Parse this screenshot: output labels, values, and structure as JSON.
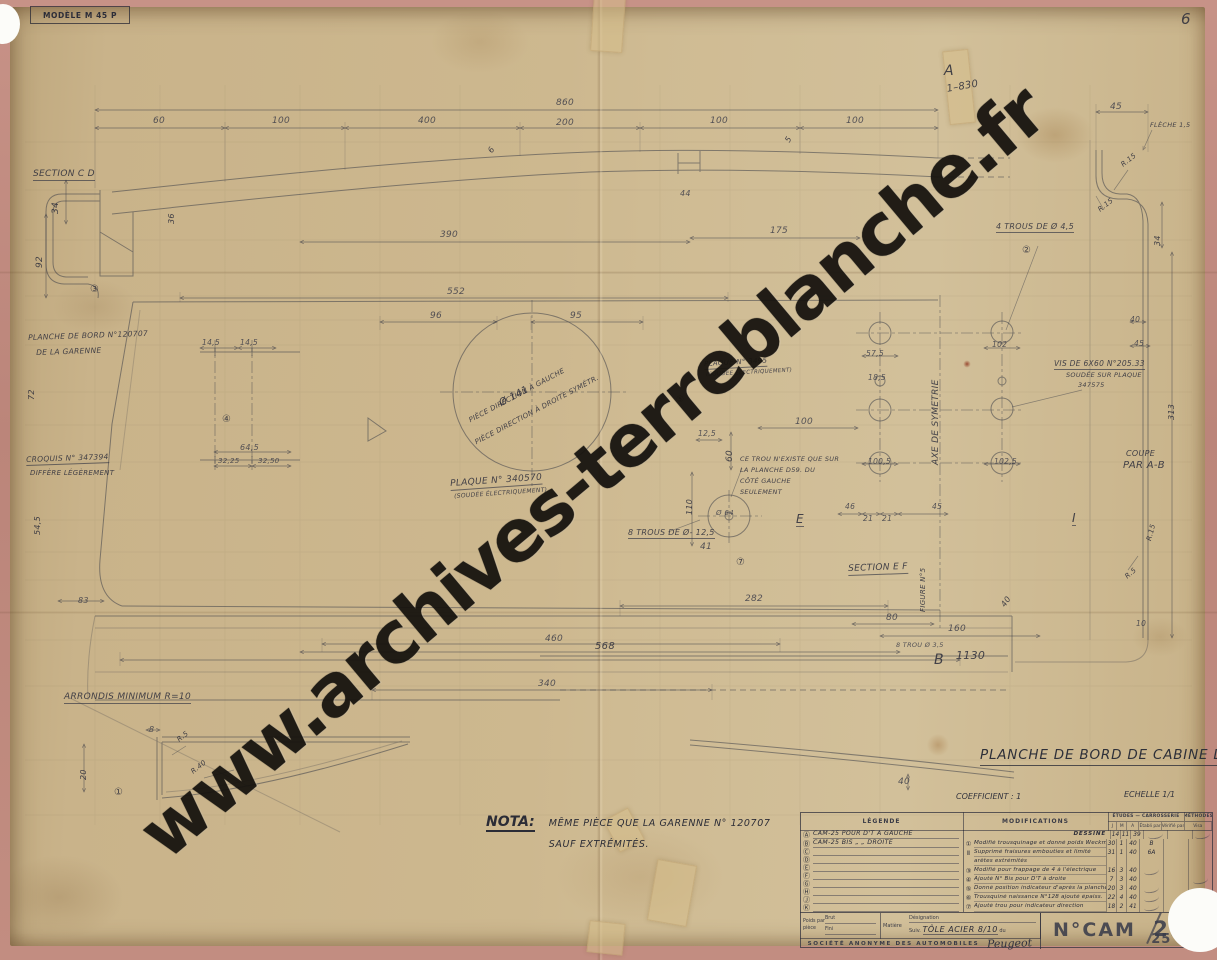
{
  "watermark": {
    "text": "www.archives-terreblanche.fr"
  },
  "stamp": {
    "label": "MODÈLE M 45 P"
  },
  "title": "PLANCHE DE BORD DE CABINE D.S.A.",
  "coefficient": "COEFFICIENT : 1",
  "echelle": "ECHELLE 1/1",
  "nota": {
    "label": "NOTA:",
    "line1": "MÊME PIÈCE QUE LA GARENNE N° 120707",
    "line2": "SAUF EXTRÉMITÉS."
  },
  "colors": {
    "paper": "#cdb88f",
    "frame": "#c08a7d",
    "ink": "#2f3039",
    "pencil": "#3e4049",
    "watermark": "#16130e"
  },
  "title_block": {
    "legend_header": "LÉGENDE",
    "modifications_header": "MODIFICATIONS",
    "dept_header_1": "ÉTUDES — CARROSSERIE",
    "dept_header_2": "MÉTHODES",
    "date_cols": [
      "J",
      "M",
      "A",
      "Établi par",
      "Vérifié par",
      "Visa"
    ],
    "legend_rows": [
      {
        "k": "Ⓐ",
        "t": "CAM-25 POUR D'T À GAUCHE"
      },
      {
        "k": "Ⓑ",
        "t": "CAM-25 BIS   „   „   DROITE"
      },
      {
        "k": "Ⓒ",
        "t": ""
      },
      {
        "k": "Ⓓ",
        "t": ""
      },
      {
        "k": "Ⓔ",
        "t": ""
      },
      {
        "k": "Ⓕ",
        "t": ""
      },
      {
        "k": "Ⓖ",
        "t": ""
      },
      {
        "k": "Ⓗ",
        "t": ""
      },
      {
        "k": "Ⓙ",
        "t": ""
      },
      {
        "k": "Ⓚ",
        "t": ""
      }
    ],
    "mod_rows": [
      {
        "n": "",
        "t": "DESSINÉ",
        "rt": true,
        "d": "14",
        "m": "11",
        "a": "39",
        "s1": true,
        "s2": true
      },
      {
        "n": "①",
        "t": "Modifié trousquinage et donné poids Weckmann",
        "d": "30",
        "m": "1",
        "a": "40",
        "by": "B"
      },
      {
        "n": "Ⅱ",
        "t": "Supprimé fraisures embouties et limité",
        "d": "31",
        "m": "1",
        "a": "40",
        "by": "6A"
      },
      {
        "n": "",
        "t": "arêtes extrémités"
      },
      {
        "n": "③",
        "t": "Modifié pour frappage de 4 à l'électrique",
        "d": "16",
        "m": "3",
        "a": "40",
        "s1": true
      },
      {
        "n": "④",
        "t": "Ajouté N° Bis pour D'T à droite",
        "d": "7",
        "m": "3",
        "a": "40",
        "s2": true
      },
      {
        "n": "⑤",
        "t": "Donné position indicateur d'après la planche",
        "d": "20",
        "m": "3",
        "a": "40",
        "s1": true
      },
      {
        "n": "⑥",
        "t": "Trousquiné naissance N°128 ajouté épaiss.",
        "d": "22",
        "m": "4",
        "a": "40",
        "s1": true,
        "s2": true
      },
      {
        "n": "⑦",
        "t": "Ajouté trou pour indicateur direction",
        "d": "18",
        "m": "2",
        "a": "41",
        "s1": true
      }
    ],
    "bottom": {
      "poids_label": "Poids par pièce",
      "brut_label": "Brut",
      "fini_label": "Fini",
      "matiere_label": "Matière",
      "designation_label": "Désignation",
      "suiv_label": "Suiv.",
      "matiere_value": "TÔLE ACIER 8/10",
      "du_label": "du",
      "number_prefix": "N°CAM",
      "number": "25",
      "number_bis": "25 BIS",
      "company": "SOCIÉTÉ ANONYME DES AUTOMOBILES",
      "brand": "Peugeot"
    }
  },
  "annotations": [
    {
      "t": "860",
      "x": 556,
      "y": 99,
      "c": "d"
    },
    {
      "t": "60",
      "x": 153,
      "y": 117,
      "c": "d"
    },
    {
      "t": "100",
      "x": 272,
      "y": 117,
      "c": "d"
    },
    {
      "t": "400",
      "x": 418,
      "y": 117,
      "c": "d"
    },
    {
      "t": "200",
      "x": 556,
      "y": 119,
      "c": "d"
    },
    {
      "t": "100",
      "x": 710,
      "y": 117,
      "c": "d"
    },
    {
      "t": "100",
      "x": 846,
      "y": 117,
      "c": "d"
    },
    {
      "t": "45",
      "x": 1110,
      "y": 103,
      "c": "d"
    },
    {
      "t": "FLÈCHE 1,5",
      "x": 1150,
      "y": 122,
      "c": "h",
      "s": 6.5
    },
    {
      "t": "A",
      "x": 944,
      "y": 64,
      "c": "h",
      "s": 14
    },
    {
      "t": "1–830",
      "x": 946,
      "y": 85,
      "c": "h",
      "s": 10,
      "r": -10
    },
    {
      "t": "6",
      "x": 1181,
      "y": 12,
      "c": "h",
      "s": 15
    },
    {
      "t": "SECTION C D",
      "x": 33,
      "y": 170,
      "c": "hu",
      "s": 9
    },
    {
      "t": "34",
      "x": 52,
      "y": 214,
      "c": "v",
      "s": 9
    },
    {
      "t": "92",
      "x": 36,
      "y": 268,
      "c": "v",
      "s": 9
    },
    {
      "t": "36",
      "x": 168,
      "y": 224,
      "c": "v",
      "s": 8
    },
    {
      "t": "6",
      "x": 487,
      "y": 150,
      "c": "h",
      "r": -55,
      "s": 8
    },
    {
      "t": "5",
      "x": 784,
      "y": 140,
      "c": "h",
      "r": -60,
      "s": 8
    },
    {
      "t": "44",
      "x": 680,
      "y": 190,
      "c": "d",
      "s": 8
    },
    {
      "t": "390",
      "x": 440,
      "y": 231,
      "c": "d"
    },
    {
      "t": "175",
      "x": 770,
      "y": 227,
      "c": "d"
    },
    {
      "t": "4 TROUS DE Ø 4,5",
      "x": 996,
      "y": 223,
      "c": "hu",
      "s": 8
    },
    {
      "t": "②",
      "x": 1022,
      "y": 246,
      "c": "h",
      "s": 10
    },
    {
      "t": "③",
      "x": 90,
      "y": 285,
      "c": "h",
      "s": 10
    },
    {
      "t": "PLANCHE DE BORD N°120707",
      "x": 28,
      "y": 334,
      "c": "h",
      "s": 7.5,
      "r": -2
    },
    {
      "t": "DE LA GARENNE",
      "x": 36,
      "y": 349,
      "c": "h",
      "s": 7.5,
      "r": -2
    },
    {
      "t": "72",
      "x": 28,
      "y": 400,
      "c": "v",
      "s": 8
    },
    {
      "t": "CROQUIS N° 347394",
      "x": 26,
      "y": 456,
      "c": "hu",
      "s": 7.5,
      "r": -2
    },
    {
      "t": "DIFFÈRE LÉGÈREMENT",
      "x": 30,
      "y": 470,
      "c": "h",
      "s": 7
    },
    {
      "t": "54,5",
      "x": 34,
      "y": 535,
      "c": "v",
      "s": 8
    },
    {
      "t": "552",
      "x": 447,
      "y": 288,
      "c": "d"
    },
    {
      "t": "96",
      "x": 430,
      "y": 312,
      "c": "d"
    },
    {
      "t": "95",
      "x": 570,
      "y": 312,
      "c": "d"
    },
    {
      "t": "14,5",
      "x": 202,
      "y": 339,
      "c": "d",
      "s": 7.5
    },
    {
      "t": "14,5",
      "x": 240,
      "y": 339,
      "c": "d",
      "s": 7.5
    },
    {
      "t": "④",
      "x": 222,
      "y": 415,
      "c": "h",
      "s": 10
    },
    {
      "t": "64,5",
      "x": 240,
      "y": 444,
      "c": "d",
      "s": 8
    },
    {
      "t": "32,25",
      "x": 218,
      "y": 458,
      "c": "d",
      "s": 7
    },
    {
      "t": "32,50",
      "x": 258,
      "y": 458,
      "c": "d",
      "s": 7
    },
    {
      "t": "Ø 141",
      "x": 498,
      "y": 400,
      "c": "h",
      "r": -28,
      "s": 10
    },
    {
      "t": "PIÈCE DIRECTION À GAUCHE",
      "x": 468,
      "y": 418,
      "c": "h",
      "r": -28,
      "s": 7
    },
    {
      "t": "PIÈCE DIRECTION À DROITE SYMÉTR.",
      "x": 474,
      "y": 440,
      "c": "h",
      "r": -28,
      "s": 7
    },
    {
      "t": "PLAQUE N° 340570",
      "x": 450,
      "y": 480,
      "c": "hu",
      "r": -4,
      "s": 9
    },
    {
      "t": "(SOUDÉE ÉLECTRIQUEMENT)",
      "x": 454,
      "y": 494,
      "c": "h",
      "s": 6,
      "r": -4
    },
    {
      "t": "PLAQUE N° 3495",
      "x": 704,
      "y": 361,
      "c": "hu",
      "s": 7,
      "r": -3
    },
    {
      "t": "(SOUDÉE ÉLECTRIQUEMENT)",
      "x": 706,
      "y": 373,
      "c": "h",
      "s": 5.5,
      "r": -3
    },
    {
      "t": "⑤",
      "x": 676,
      "y": 396,
      "c": "h",
      "s": 9
    },
    {
      "t": "12,5",
      "x": 698,
      "y": 430,
      "c": "d",
      "s": 7.5
    },
    {
      "t": "60",
      "x": 726,
      "y": 462,
      "c": "v",
      "s": 9
    },
    {
      "t": "100",
      "x": 795,
      "y": 418,
      "c": "d"
    },
    {
      "t": "CE TROU N'EXISTE QUE SUR",
      "x": 740,
      "y": 456,
      "c": "h",
      "s": 6.5
    },
    {
      "t": "LA PLANCHE D59. DU",
      "x": 740,
      "y": 467,
      "c": "h",
      "s": 6.5
    },
    {
      "t": "CÔTÉ GAUCHE",
      "x": 740,
      "y": 478,
      "c": "h",
      "s": 6.5
    },
    {
      "t": "SEULEMENT",
      "x": 740,
      "y": 489,
      "c": "h",
      "s": 6.5
    },
    {
      "t": "110",
      "x": 686,
      "y": 515,
      "c": "v",
      "s": 8
    },
    {
      "t": "Ø 64",
      "x": 716,
      "y": 510,
      "c": "d",
      "s": 7
    },
    {
      "t": "8 TROUS DE Ø- 12,5",
      "x": 628,
      "y": 529,
      "c": "hu",
      "s": 8
    },
    {
      "t": "41",
      "x": 700,
      "y": 543,
      "c": "d"
    },
    {
      "t": "⑦",
      "x": 736,
      "y": 558,
      "c": "h",
      "s": 10
    },
    {
      "t": "E",
      "x": 796,
      "y": 513,
      "c": "hu",
      "s": 12
    },
    {
      "t": "SECTION E F",
      "x": 848,
      "y": 565,
      "c": "hu",
      "s": 9,
      "r": -2
    },
    {
      "t": "FIGURE N°5",
      "x": 920,
      "y": 612,
      "c": "v",
      "s": 7
    },
    {
      "t": "46",
      "x": 845,
      "y": 503,
      "c": "d",
      "s": 7.5
    },
    {
      "t": "21",
      "x": 863,
      "y": 515,
      "c": "d",
      "s": 7.5
    },
    {
      "t": "21",
      "x": 882,
      "y": 515,
      "c": "d",
      "s": 7.5
    },
    {
      "t": "45",
      "x": 932,
      "y": 503,
      "c": "d",
      "s": 7.5
    },
    {
      "t": "57,5",
      "x": 866,
      "y": 350,
      "c": "d",
      "s": 7.5
    },
    {
      "t": "18,5",
      "x": 868,
      "y": 374,
      "c": "d",
      "s": 7.5
    },
    {
      "t": "102",
      "x": 992,
      "y": 341,
      "c": "d",
      "s": 7.5
    },
    {
      "t": "100,5",
      "x": 868,
      "y": 458,
      "c": "d",
      "s": 7.5
    },
    {
      "t": "102,5",
      "x": 994,
      "y": 458,
      "c": "d",
      "s": 7.5
    },
    {
      "t": "AXE DE SYMETRIE",
      "x": 932,
      "y": 465,
      "c": "v",
      "s": 9
    },
    {
      "t": "VIS DE 6X60 N°205.33",
      "x": 1054,
      "y": 360,
      "c": "hu",
      "s": 7.5
    },
    {
      "t": "SOUDÉE SUR PLAQUE",
      "x": 1066,
      "y": 372,
      "c": "h",
      "s": 6.5
    },
    {
      "t": "347575",
      "x": 1078,
      "y": 382,
      "c": "h",
      "s": 6.5
    },
    {
      "t": "COUPE",
      "x": 1126,
      "y": 450,
      "c": "h",
      "s": 8
    },
    {
      "t": "PAR A-B",
      "x": 1123,
      "y": 461,
      "c": "h",
      "s": 10
    },
    {
      "t": "R.15",
      "x": 1120,
      "y": 163,
      "c": "h",
      "r": -38,
      "s": 7
    },
    {
      "t": "R.15",
      "x": 1097,
      "y": 208,
      "c": "h",
      "r": -38,
      "s": 7
    },
    {
      "t": "34",
      "x": 1154,
      "y": 246,
      "c": "v",
      "s": 8
    },
    {
      "t": "40",
      "x": 1130,
      "y": 316,
      "c": "d",
      "s": 7.5
    },
    {
      "t": "45",
      "x": 1134,
      "y": 340,
      "c": "d",
      "s": 7.5
    },
    {
      "t": "313",
      "x": 1168,
      "y": 420,
      "c": "v",
      "s": 8
    },
    {
      "t": "R.15",
      "x": 1146,
      "y": 540,
      "c": "h",
      "r": -75,
      "s": 7
    },
    {
      "t": "R.5",
      "x": 1124,
      "y": 575,
      "c": "h",
      "r": -40,
      "s": 7
    },
    {
      "t": "I",
      "x": 1072,
      "y": 512,
      "c": "hu",
      "s": 12
    },
    {
      "t": "282",
      "x": 745,
      "y": 595,
      "c": "d"
    },
    {
      "t": "80",
      "x": 886,
      "y": 614,
      "c": "d"
    },
    {
      "t": "160",
      "x": 948,
      "y": 625,
      "c": "d"
    },
    {
      "t": "1130",
      "x": 956,
      "y": 650,
      "c": "h",
      "s": 11
    },
    {
      "t": "B",
      "x": 934,
      "y": 653,
      "c": "h",
      "s": 14
    },
    {
      "t": "8 TROU Ø 3,5",
      "x": 896,
      "y": 642,
      "c": "d",
      "s": 6.5
    },
    {
      "t": "40",
      "x": 1000,
      "y": 604,
      "c": "h",
      "r": -55,
      "s": 8
    },
    {
      "t": "10",
      "x": 1136,
      "y": 620,
      "c": "d",
      "s": 7.5
    },
    {
      "t": "460",
      "x": 545,
      "y": 635,
      "c": "d"
    },
    {
      "t": "568",
      "x": 595,
      "y": 642,
      "c": "h",
      "s": 10
    },
    {
      "t": "340",
      "x": 538,
      "y": 680,
      "c": "d"
    },
    {
      "t": "83",
      "x": 78,
      "y": 597,
      "c": "d",
      "s": 8
    },
    {
      "t": "ARRONDIS MINIMUM R=10",
      "x": 64,
      "y": 693,
      "c": "hu",
      "s": 9
    },
    {
      "t": "8",
      "x": 149,
      "y": 726,
      "c": "d",
      "s": 8
    },
    {
      "t": "20",
      "x": 80,
      "y": 780,
      "c": "v",
      "s": 8
    },
    {
      "t": "R.5",
      "x": 176,
      "y": 738,
      "c": "h",
      "r": -38,
      "s": 7
    },
    {
      "t": "R.40",
      "x": 190,
      "y": 770,
      "c": "h",
      "r": -38,
      "s": 7
    },
    {
      "t": "①",
      "x": 114,
      "y": 788,
      "c": "h",
      "s": 10
    },
    {
      "t": "40",
      "x": 898,
      "y": 778,
      "c": "d"
    }
  ]
}
